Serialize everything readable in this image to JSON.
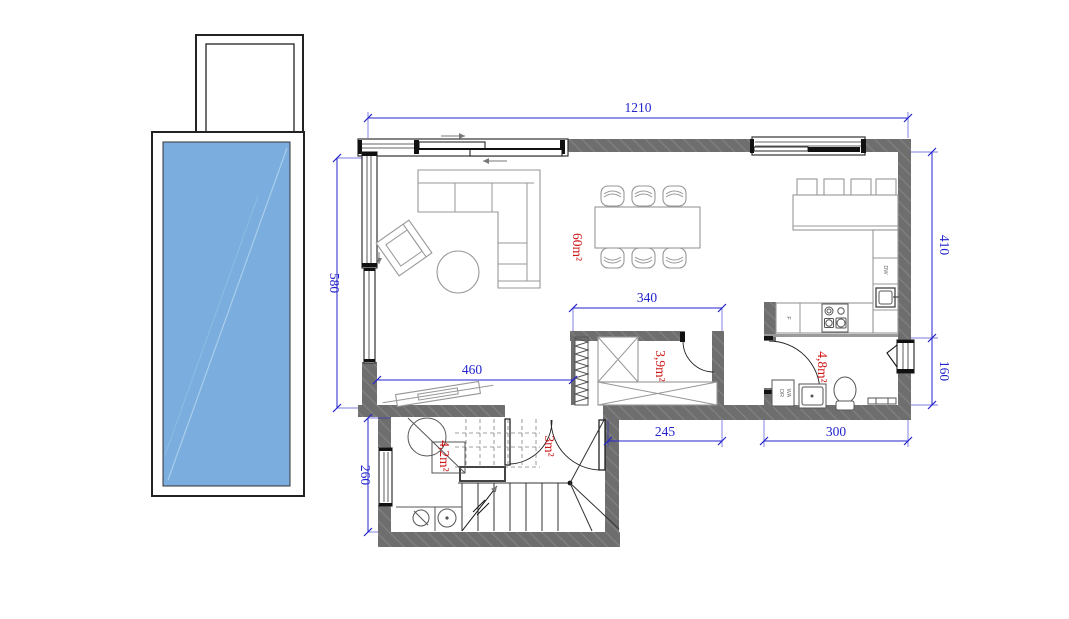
{
  "plan": {
    "type": "floor-plan",
    "colors": {
      "pool_water": "#7badde",
      "wall_gray": "#6e6e6e",
      "dimension_blue": "#2323cd",
      "room_label_red": "#cd1616"
    },
    "dimensions": {
      "top_width": "1210",
      "left_height": "580",
      "right_upper_height": "410",
      "right_lower_height": "160",
      "storage_width": "340",
      "living_bottom_width": "460",
      "hall_width": "245",
      "laundry_width": "300",
      "extension_height": "260"
    },
    "rooms": {
      "living_kitchen": "60m²",
      "storage": "3,9m²",
      "laundry_wc": "4,8m²",
      "bathroom": "4,2m²",
      "hall": "3m²"
    },
    "appliances": {
      "dishwasher": "DW",
      "fridge": "F",
      "dryer": "DR",
      "washer": "WA"
    }
  }
}
